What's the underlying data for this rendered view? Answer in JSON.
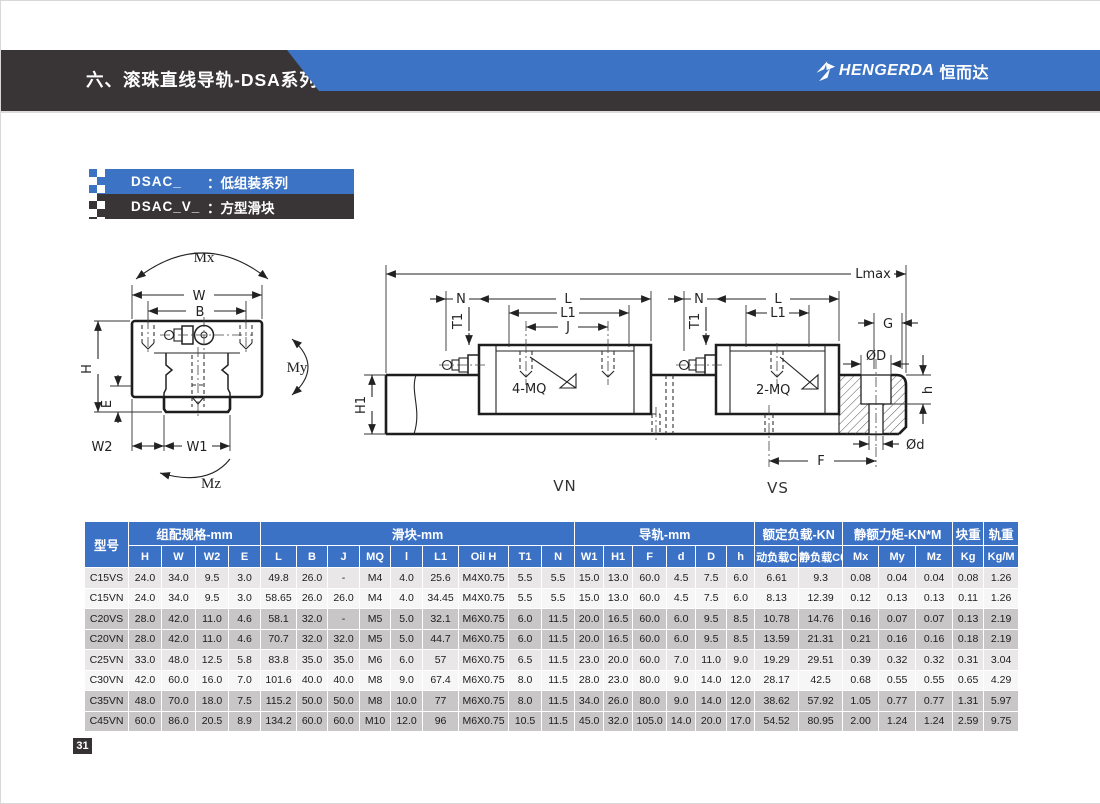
{
  "page": {
    "number": "31"
  },
  "header": {
    "title": "六、滚珠直线导轨-DSA系列",
    "brand_latin": "HENGERDA",
    "brand_cn": "恒而达",
    "accent_blue": "#3c73c4",
    "band_dark": "#393536"
  },
  "series_labels": {
    "row1_code": "DSAC_",
    "row1_desc": "：低组装系列",
    "row2_code": "DSAC_V_",
    "row2_desc": "：方型滑块"
  },
  "diagram_left": {
    "labels": {
      "mx": "Mx",
      "w": "W",
      "b": "B",
      "h": "H",
      "e": "E",
      "w2": "W2",
      "w1": "W1",
      "my": "My",
      "mz": "Mz"
    }
  },
  "diagram_right": {
    "labels": {
      "lmax": "Lmax",
      "h1": "H1",
      "n_left": "N",
      "t1_left": "T1",
      "l_left": "L",
      "l1_left": "L1",
      "j": "J",
      "mq4": "4-MQ",
      "n_right": "N",
      "t1_right": "T1",
      "l_right": "L",
      "l1_right": "L1",
      "mq2": "2-MQ",
      "g": "G",
      "d_big": "ØD",
      "h_small": "h",
      "d_small": "Ød",
      "f": "F",
      "vn": "VN",
      "vs": "VS"
    }
  },
  "table": {
    "model_header": "型号",
    "groups": [
      {
        "label": "组配规格-mm"
      },
      {
        "label": "滑块-mm"
      },
      {
        "label": "导轨-mm"
      },
      {
        "label": "额定负载-KN"
      },
      {
        "label": "静额力矩-KN*M"
      },
      {
        "label": "块重"
      },
      {
        "label": "轨重"
      }
    ],
    "sub_headers": [
      "H",
      "W",
      "W2",
      "E",
      "L",
      "B",
      "J",
      "MQ",
      "l",
      "L1",
      "Oil H",
      "T1",
      "N",
      "W1",
      "H1",
      "F",
      "d",
      "D",
      "h",
      "动负载C",
      "静负载C0",
      "Mx",
      "My",
      "Mz",
      "Kg",
      "Kg/M"
    ],
    "rows": [
      {
        "model": "C15VS",
        "values": [
          "24.0",
          "34.0",
          "9.5",
          "3.0",
          "49.8",
          "26.0",
          "-",
          "M4",
          "4.0",
          "25.6",
          "M4X0.75",
          "5.5",
          "5.5",
          "15.0",
          "13.0",
          "60.0",
          "4.5",
          "7.5",
          "6.0",
          "6.61",
          "9.3",
          "0.08",
          "0.04",
          "0.04",
          "0.08",
          "1.26"
        ]
      },
      {
        "model": "C15VN",
        "values": [
          "24.0",
          "34.0",
          "9.5",
          "3.0",
          "58.65",
          "26.0",
          "26.0",
          "M4",
          "4.0",
          "34.45",
          "M4X0.75",
          "5.5",
          "5.5",
          "15.0",
          "13.0",
          "60.0",
          "4.5",
          "7.5",
          "6.0",
          "8.13",
          "12.39",
          "0.12",
          "0.13",
          "0.13",
          "0.11",
          "1.26"
        ]
      },
      {
        "model": "C20VS",
        "values": [
          "28.0",
          "42.0",
          "11.0",
          "4.6",
          "58.1",
          "32.0",
          "-",
          "M5",
          "5.0",
          "32.1",
          "M6X0.75",
          "6.0",
          "11.5",
          "20.0",
          "16.5",
          "60.0",
          "6.0",
          "9.5",
          "8.5",
          "10.78",
          "14.76",
          "0.16",
          "0.07",
          "0.07",
          "0.13",
          "2.19"
        ]
      },
      {
        "model": "C20VN",
        "values": [
          "28.0",
          "42.0",
          "11.0",
          "4.6",
          "70.7",
          "32.0",
          "32.0",
          "M5",
          "5.0",
          "44.7",
          "M6X0.75",
          "6.0",
          "11.5",
          "20.0",
          "16.5",
          "60.0",
          "6.0",
          "9.5",
          "8.5",
          "13.59",
          "21.31",
          "0.21",
          "0.16",
          "0.16",
          "0.18",
          "2.19"
        ]
      },
      {
        "model": "C25VN",
        "values": [
          "33.0",
          "48.0",
          "12.5",
          "5.8",
          "83.8",
          "35.0",
          "35.0",
          "M6",
          "6.0",
          "57",
          "M6X0.75",
          "6.5",
          "11.5",
          "23.0",
          "20.0",
          "60.0",
          "7.0",
          "11.0",
          "9.0",
          "19.29",
          "29.51",
          "0.39",
          "0.32",
          "0.32",
          "0.31",
          "3.04"
        ]
      },
      {
        "model": "C30VN",
        "values": [
          "42.0",
          "60.0",
          "16.0",
          "7.0",
          "101.6",
          "40.0",
          "40.0",
          "M8",
          "9.0",
          "67.4",
          "M6X0.75",
          "8.0",
          "11.5",
          "28.0",
          "23.0",
          "80.0",
          "9.0",
          "14.0",
          "12.0",
          "28.17",
          "42.5",
          "0.68",
          "0.55",
          "0.55",
          "0.65",
          "4.29"
        ]
      },
      {
        "model": "C35VN",
        "values": [
          "48.0",
          "70.0",
          "18.0",
          "7.5",
          "115.2",
          "50.0",
          "50.0",
          "M8",
          "10.0",
          "77",
          "M6X0.75",
          "8.0",
          "11.5",
          "34.0",
          "26.0",
          "80.0",
          "9.0",
          "14.0",
          "12.0",
          "38.62",
          "57.92",
          "1.05",
          "0.77",
          "0.77",
          "1.31",
          "5.97"
        ]
      },
      {
        "model": "C45VN",
        "values": [
          "60.0",
          "86.0",
          "20.5",
          "8.9",
          "134.2",
          "60.0",
          "60.0",
          "M10",
          "12.0",
          "96",
          "M6X0.75",
          "10.5",
          "11.5",
          "45.0",
          "32.0",
          "105.0",
          "14.0",
          "20.0",
          "17.0",
          "54.52",
          "80.95",
          "2.00",
          "1.24",
          "1.24",
          "2.59",
          "9.75"
        ]
      }
    ]
  }
}
